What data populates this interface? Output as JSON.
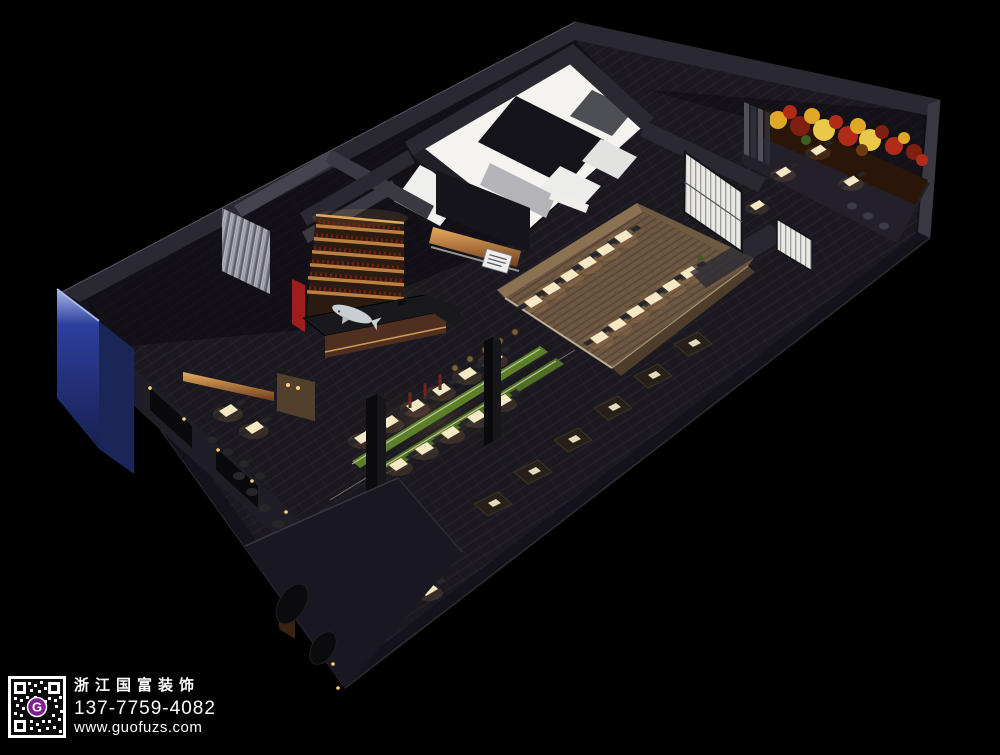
{
  "scene": {
    "type": "3d-interior-rendering",
    "subject": "bird's-eye night view of a restaurant interior floor plan"
  },
  "watermark": {
    "company": "浙江国富装饰",
    "phone": "137-7759-4082",
    "website": "www.guofuzs.com",
    "qr_logo_letter": "G"
  },
  "colors": {
    "background": "#000000",
    "textWhite": "#ffffff",
    "qrPurple": "#7c1f8f",
    "wallTop": "#2a2831",
    "wallTopLight": "#3a3943",
    "wallFace": "#14121a",
    "floorTile": "#1b191f",
    "floorLine": "#242230",
    "kitchenWhite": "#f4f3ef",
    "kitchenShadow": "#d9d8d6",
    "grayWall": "#b4b4b8",
    "darkPartition": "#15141a",
    "woodFloor": "#6b5540",
    "woodWallTop": "#8a7152",
    "woodWallFace": "#4f3d2b",
    "tableGlow": "#f5e8c4",
    "amber": "#e2a155",
    "copperDark": "#6e3d1c",
    "copperLight": "#e8ab5e",
    "wineGlow": "#f0b766",
    "wineShelfDark": "#2b1b10",
    "bottleRed": "#7d2017",
    "green": "#5c8028",
    "greenDark": "#3f5c22",
    "foliageRed": "#b22b18",
    "foliageRedDark": "#7e1f12",
    "foliageGold": "#dfa825",
    "foliageGoldLight": "#ecc84a",
    "accentRed": "#a01d1d",
    "blueFace": "#2e3f9e",
    "blueDark": "#16204f",
    "blueHighlight": "#aab8e8",
    "screenWhite": "#eae9e3",
    "screenLine": "#56555e",
    "chairDark": "#26262b",
    "sharkGray": "#c9ced3",
    "signWhite": "#ededef",
    "lightDot": "#ffd27a"
  }
}
